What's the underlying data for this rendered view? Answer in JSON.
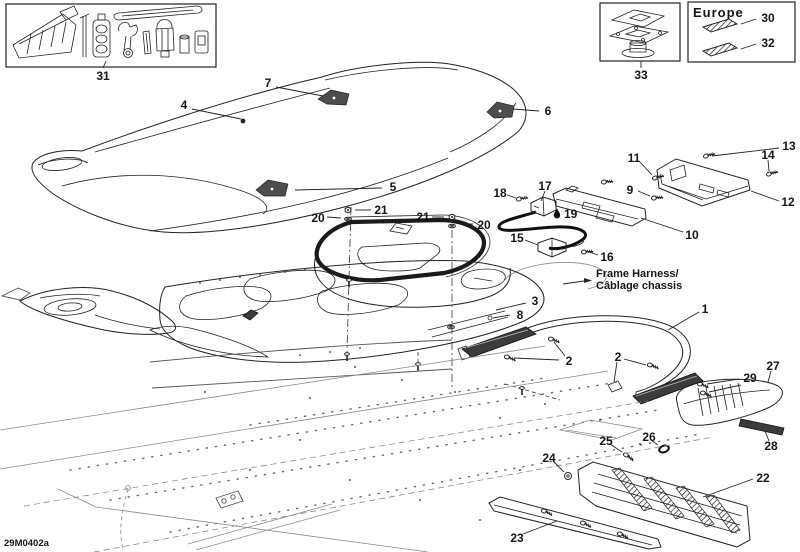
{
  "doc": {
    "code": "29M0402a",
    "europe": "Europe",
    "frame_harness_line1": "Frame Harness/",
    "frame_harness_line2": "Câblage chassis"
  },
  "callouts": {
    "c1": "1",
    "c2": "2",
    "c3": "3",
    "c4": "4",
    "c5": "5",
    "c6": "6",
    "c7": "7",
    "c8": "8",
    "c9": "9",
    "c10": "10",
    "c11": "11",
    "c12": "12",
    "c13": "13",
    "c14": "14",
    "c15": "15",
    "c16": "16",
    "c17": "17",
    "c18": "18",
    "c19": "19",
    "c20": "20",
    "c21": "21",
    "c22": "22",
    "c23": "23",
    "c24": "24",
    "c25": "25",
    "c26": "26",
    "c27": "27",
    "c28": "28",
    "c29": "29",
    "c30": "30",
    "c31": "31",
    "c32": "32",
    "c33": "33"
  },
  "icons": {
    "droplet": "lubricant-droplet-icon",
    "arrow": "right-arrow-icon"
  },
  "colors": {
    "ink": "#222222",
    "light_ink": "#8a8a8a",
    "dark_fill": "#3c3c3c",
    "paper": "#ffffff"
  }
}
